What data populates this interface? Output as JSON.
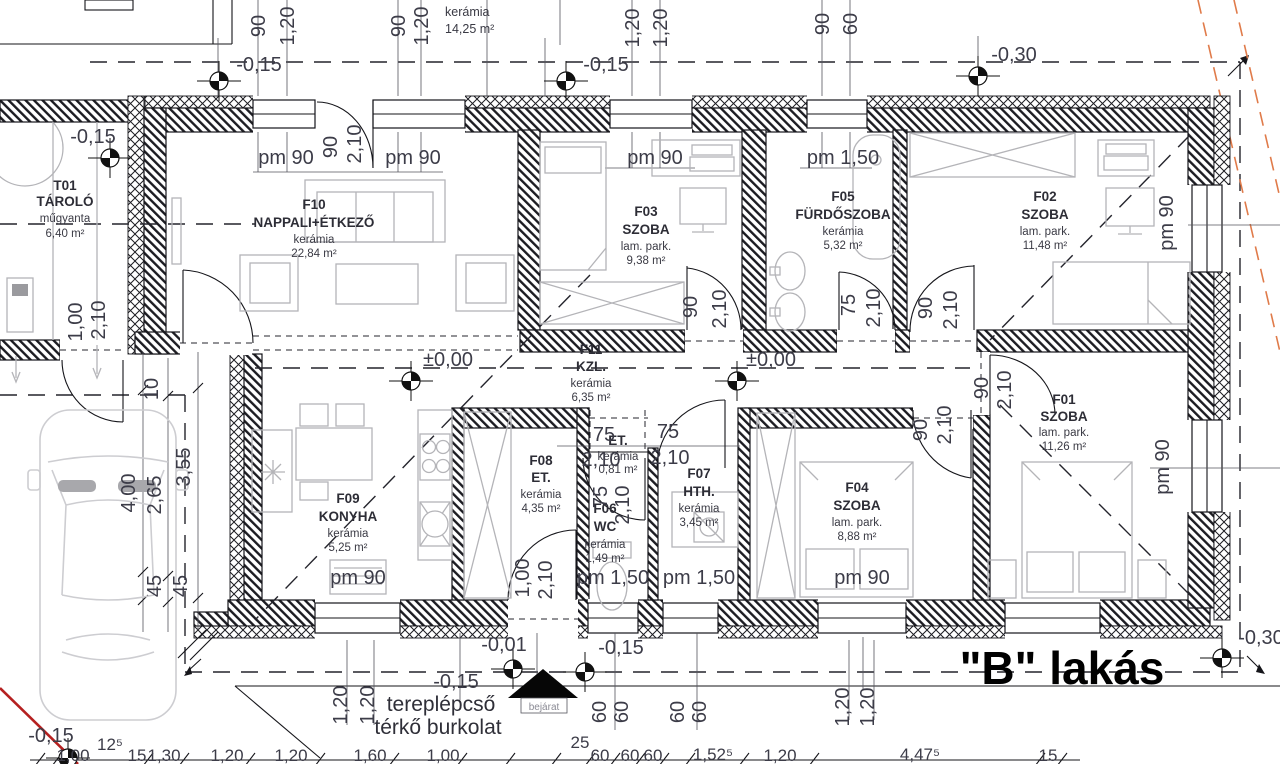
{
  "doc": {
    "type": "architectural floor plan",
    "apartment_label": "\"B\" lakás"
  },
  "notes": {
    "apartment": "\"B\" lakás",
    "entrance": "bejárat",
    "terrain1": "tereplépcső",
    "terrain2": "térkő burkolat",
    "top_partial_mat": "kerámia",
    "top_partial_area": "14,25 m²"
  },
  "rooms": [
    {
      "id": "T01",
      "name": "TÁROLÓ",
      "mat": "műgyanta",
      "area": "6,40 m²"
    },
    {
      "id": "F10",
      "name": "NAPPALI+ÉTKEZŐ",
      "mat": "kerámia",
      "area": "22,84 m²"
    },
    {
      "id": "F03",
      "name": "SZOBA",
      "mat": "lam. park.",
      "area": "9,38 m²"
    },
    {
      "id": "F05",
      "name": "FÜRDŐSZOBA",
      "mat": "kerámia",
      "area": "5,32 m²"
    },
    {
      "id": "F02",
      "name": "SZOBA",
      "mat": "lam. park.",
      "area": "11,48 m²"
    },
    {
      "id": "F11",
      "name": "KZL.",
      "mat": "kerámia",
      "area": "6,35 m²"
    },
    {
      "id": "F09",
      "name": "KONYHA",
      "mat": "kerámia",
      "area": "5,25 m²"
    },
    {
      "id": "F08",
      "name": "ET.",
      "mat": "kerámia",
      "area": "4,35 m²"
    },
    {
      "id": "",
      "name": "ET.",
      "mat": "kerámia",
      "area": "0,81 m²"
    },
    {
      "id": "F06",
      "name": "WC",
      "mat": "kerámia",
      "area": "1,49 m²"
    },
    {
      "id": "F07",
      "name": "HTH.",
      "mat": "kerámia",
      "area": "3,45 m²"
    },
    {
      "id": "F04",
      "name": "SZOBA",
      "mat": "lam. park.",
      "area": "8,88 m²"
    },
    {
      "id": "F01",
      "name": "SZOBA",
      "mat": "lam. park.",
      "area": "11,26 m²"
    }
  ],
  "lv": [
    {
      "t": "-0,15"
    },
    {
      "t": "-0,15"
    },
    {
      "t": "-0,15"
    },
    {
      "t": "-0,30"
    },
    {
      "t": "±0,00"
    },
    {
      "t": "±0,00"
    },
    {
      "t": "-0,01"
    },
    {
      "t": "-0,15"
    },
    {
      "t": "-0,15"
    },
    {
      "t": "-0,30"
    },
    {
      "t": "-0,15"
    }
  ],
  "sill": [
    {
      "t": "pm 90"
    },
    {
      "t": "pm 90"
    },
    {
      "t": "pm 90"
    },
    {
      "t": "pm 1,50"
    },
    {
      "t": "pm 90"
    },
    {
      "t": "pm 90"
    },
    {
      "t": "pm 1,50"
    },
    {
      "t": "pm 1,50"
    },
    {
      "t": "pm 90"
    },
    {
      "t": "pm 90"
    }
  ],
  "dd": [
    {
      "w": "1,00",
      "h": "2,10"
    },
    {
      "w": "90",
      "h": "2,10"
    },
    {
      "w": "90",
      "h": "2,10"
    },
    {
      "w": "75",
      "h": "2,10"
    },
    {
      "w": "90",
      "h": "2,10"
    },
    {
      "w": "90",
      "h": "2,10"
    },
    {
      "w": "90",
      "h": "2,10"
    },
    {
      "w": "1,00",
      "h": "2,10"
    },
    {
      "w": "75",
      "h": "2,10"
    }
  ],
  "vd": [
    {
      "w": "75",
      "h": "2,10"
    },
    {
      "w": "75",
      "h": "2,10"
    }
  ],
  "td": [
    {
      "t": "90"
    },
    {
      "t": "1,20"
    },
    {
      "t": "90"
    },
    {
      "t": "1,20"
    },
    {
      "t": "1,20"
    },
    {
      "t": "1,20"
    },
    {
      "t": "90"
    },
    {
      "t": "60"
    }
  ],
  "sd": [
    {
      "t": "10"
    },
    {
      "t": "3,55"
    },
    {
      "t": "4,00"
    },
    {
      "t": "2,65"
    },
    {
      "t": "45"
    },
    {
      "t": "45"
    }
  ],
  "bv": [
    {
      "t": "1,20"
    },
    {
      "t": "1,20"
    },
    {
      "t": "60"
    },
    {
      "t": "60"
    },
    {
      "t": "60"
    },
    {
      "t": "60"
    },
    {
      "t": "1,20"
    },
    {
      "t": "1,20"
    }
  ],
  "bc": [
    {
      "t": "1,00"
    },
    {
      "t": "12⁵"
    },
    {
      "t": "15"
    },
    {
      "t": "1,30"
    },
    {
      "t": "1,20"
    },
    {
      "t": "1,20"
    },
    {
      "t": "1,60"
    },
    {
      "t": "1,00"
    },
    {
      "t": "25"
    },
    {
      "t": "60"
    },
    {
      "t": "60"
    },
    {
      "t": "60"
    },
    {
      "t": "1,52⁵"
    },
    {
      "t": "1,20"
    },
    {
      "t": "4,47⁵"
    },
    {
      "t": "15"
    }
  ],
  "colors": {
    "wall": "#15151a",
    "furniture": "#b4b4b8",
    "orange": "#e07b4a",
    "red": "#b52020",
    "text": "#3c3c48"
  }
}
